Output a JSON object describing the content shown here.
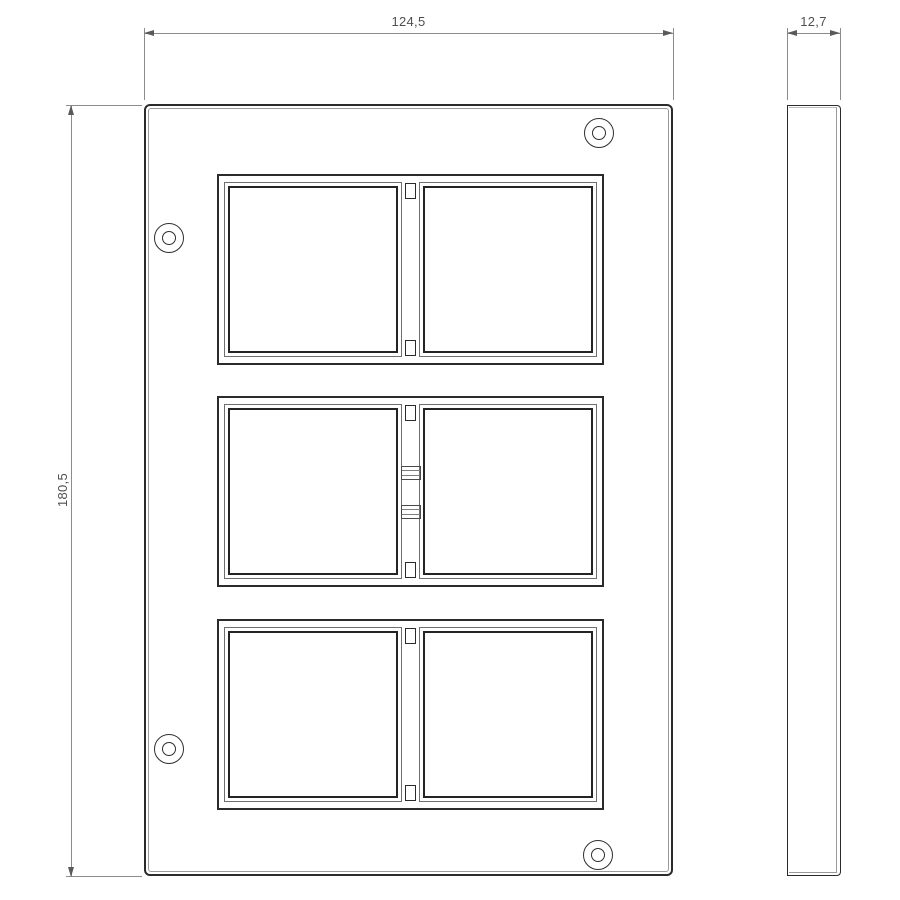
{
  "drawing": {
    "type": "technical-dimension-drawing",
    "subject": "6-module cover plate, front view and side view",
    "dimensions": {
      "front_width": "124,5",
      "front_height": "180,5",
      "side_thickness": "12,7"
    },
    "front_view": {
      "module_rows": 3,
      "openings_per_row": 2,
      "screw_holes": 4
    },
    "side_view": {
      "shape": "thin vertical slab"
    },
    "colors": {
      "background": "#ffffff",
      "object_line": "#2b2b2b",
      "bevel_line": "#9a9a9a",
      "dimension_line": "#8c8c8c",
      "arrow": "#5a5a5a",
      "text": "#4f4f4f"
    }
  }
}
